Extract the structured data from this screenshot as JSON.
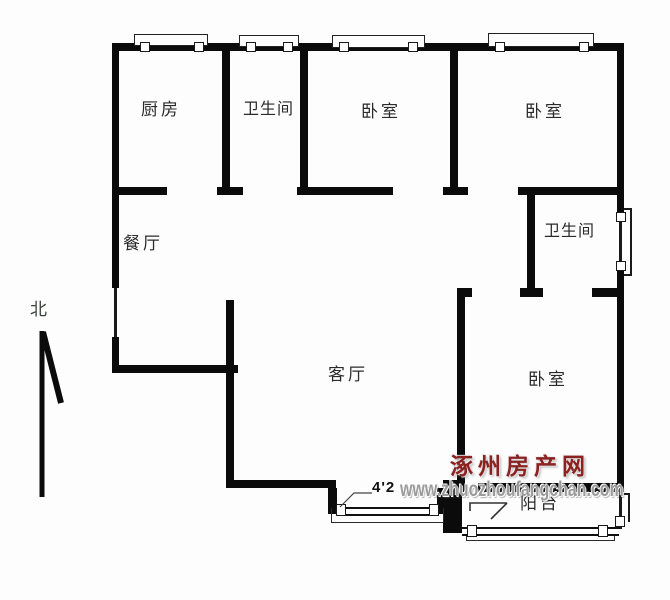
{
  "floorplan": {
    "rooms": [
      {
        "id": "kitchen",
        "label": "厨房"
      },
      {
        "id": "bathroom-top",
        "label": "卫生间"
      },
      {
        "id": "bedroom-top-left",
        "label": "卧室"
      },
      {
        "id": "bedroom-top-right",
        "label": "卧室"
      },
      {
        "id": "dining-room",
        "label": "餐厅"
      },
      {
        "id": "bathroom-right",
        "label": "卫生间"
      },
      {
        "id": "living-room",
        "label": "客厅"
      },
      {
        "id": "bedroom-bottom",
        "label": "卧室"
      },
      {
        "id": "balcony",
        "label": "阳台"
      }
    ],
    "north_label": "北",
    "dimension_label": "4'2",
    "icons": {
      "north_arrow": "up-arrow"
    }
  },
  "watermark": {
    "site_name": "涿州房产网",
    "site_url": "www.zhuozhoufangchan.com",
    "name_color": "#8b2222",
    "url_color": "#9b9b9b"
  },
  "colors": {
    "wall": "#0b0b0b",
    "background": "#fdfdfd",
    "label_text": "#2a2a2a"
  }
}
